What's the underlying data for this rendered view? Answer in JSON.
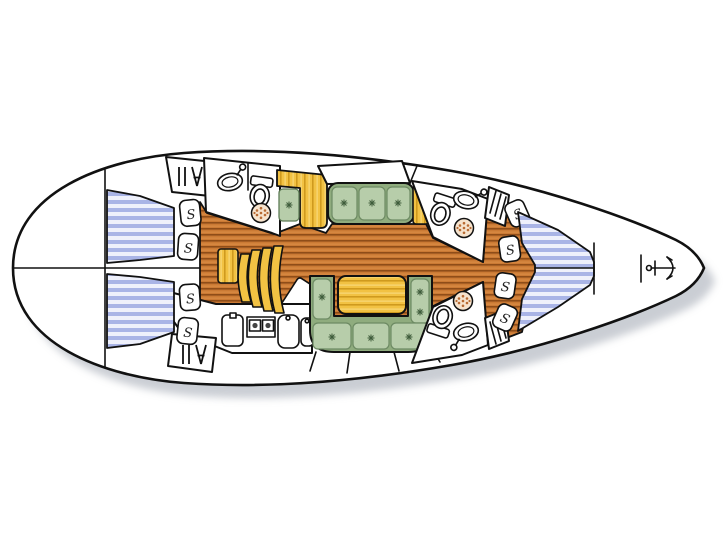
{
  "diagram": {
    "title": "Sailing yacht interior layout plan (bow right, stern left)",
    "locker_label": "S",
    "areas": [
      {
        "name": "aft-cabin-port",
        "features": [
          "double-berth"
        ]
      },
      {
        "name": "aft-cabin-starboard",
        "features": [
          "double-berth"
        ]
      },
      {
        "name": "aft-head",
        "features": [
          "toilet",
          "sink",
          "shower-drain"
        ]
      },
      {
        "name": "galley",
        "features": [
          "fridge",
          "two-burner-stove",
          "double-sink",
          "sideboard"
        ]
      },
      {
        "name": "chart-table",
        "features": [
          "tilted-desk"
        ]
      },
      {
        "name": "companionway-steps",
        "features": [
          "landing",
          "four-curved-treads"
        ]
      },
      {
        "name": "salon",
        "features": [
          "port-settee-3-cushions",
          "u-shaped-settee",
          "dining-table"
        ]
      },
      {
        "name": "forward-head-port",
        "features": [
          "toilet",
          "sink",
          "shower-drain"
        ]
      },
      {
        "name": "forward-head-starboard",
        "features": [
          "toilet",
          "sink",
          "shower-drain"
        ]
      },
      {
        "name": "forward-cabin",
        "features": [
          "v-berth"
        ]
      },
      {
        "name": "anchor-locker",
        "features": [
          "anchor"
        ]
      }
    ],
    "counts": {
      "shelf_lockers": 8,
      "hanging_lockers": 4,
      "berths": 3,
      "heads": 3,
      "stove_burners": 2
    },
    "palette": {
      "outline": "#111111",
      "hull": "#ffffff",
      "teak_floor": "#cb7a34",
      "teak_line": "#8f4d18",
      "berth_mattress_stripe": "#a9b4e6",
      "berth_mattress_light": "#eef0fb",
      "cushion_green": "#b7cdaa",
      "settee_base_green": "#8fac7e",
      "wood_yellow": "#f2c243",
      "wood_grain": "#cf9a1e",
      "drain_tan": "#f6e3cd",
      "shadow": "#b9bec6"
    }
  }
}
